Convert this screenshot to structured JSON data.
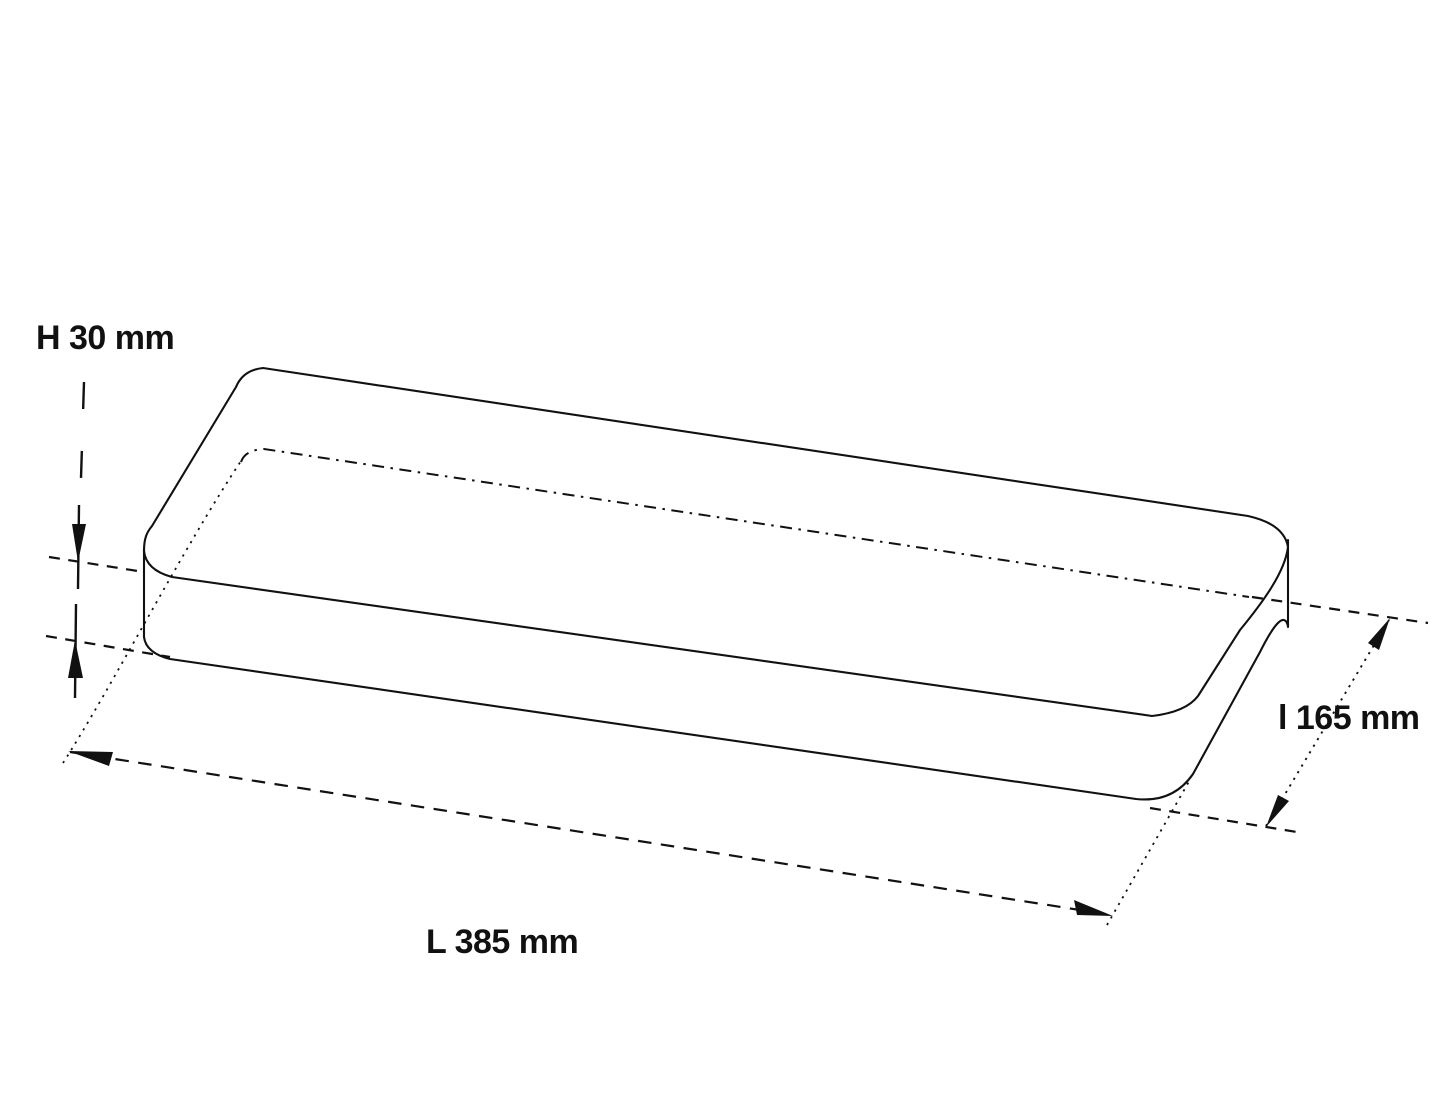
{
  "page": {
    "background": "#ffffff",
    "line_color": "#111111",
    "text_color": "#111111"
  },
  "drawing": {
    "object": "rounded-rectangular-slab",
    "view": "isometric-dimension-drawing",
    "dimensions": {
      "height": {
        "label": "H 30 mm",
        "symbol": "H",
        "value": 30,
        "unit": "mm"
      },
      "length": {
        "label": "L 385 mm",
        "symbol": "L",
        "value": 385,
        "unit": "mm"
      },
      "depth": {
        "label": "l 165 mm",
        "symbol": "l",
        "value": 165,
        "unit": "mm"
      }
    }
  }
}
